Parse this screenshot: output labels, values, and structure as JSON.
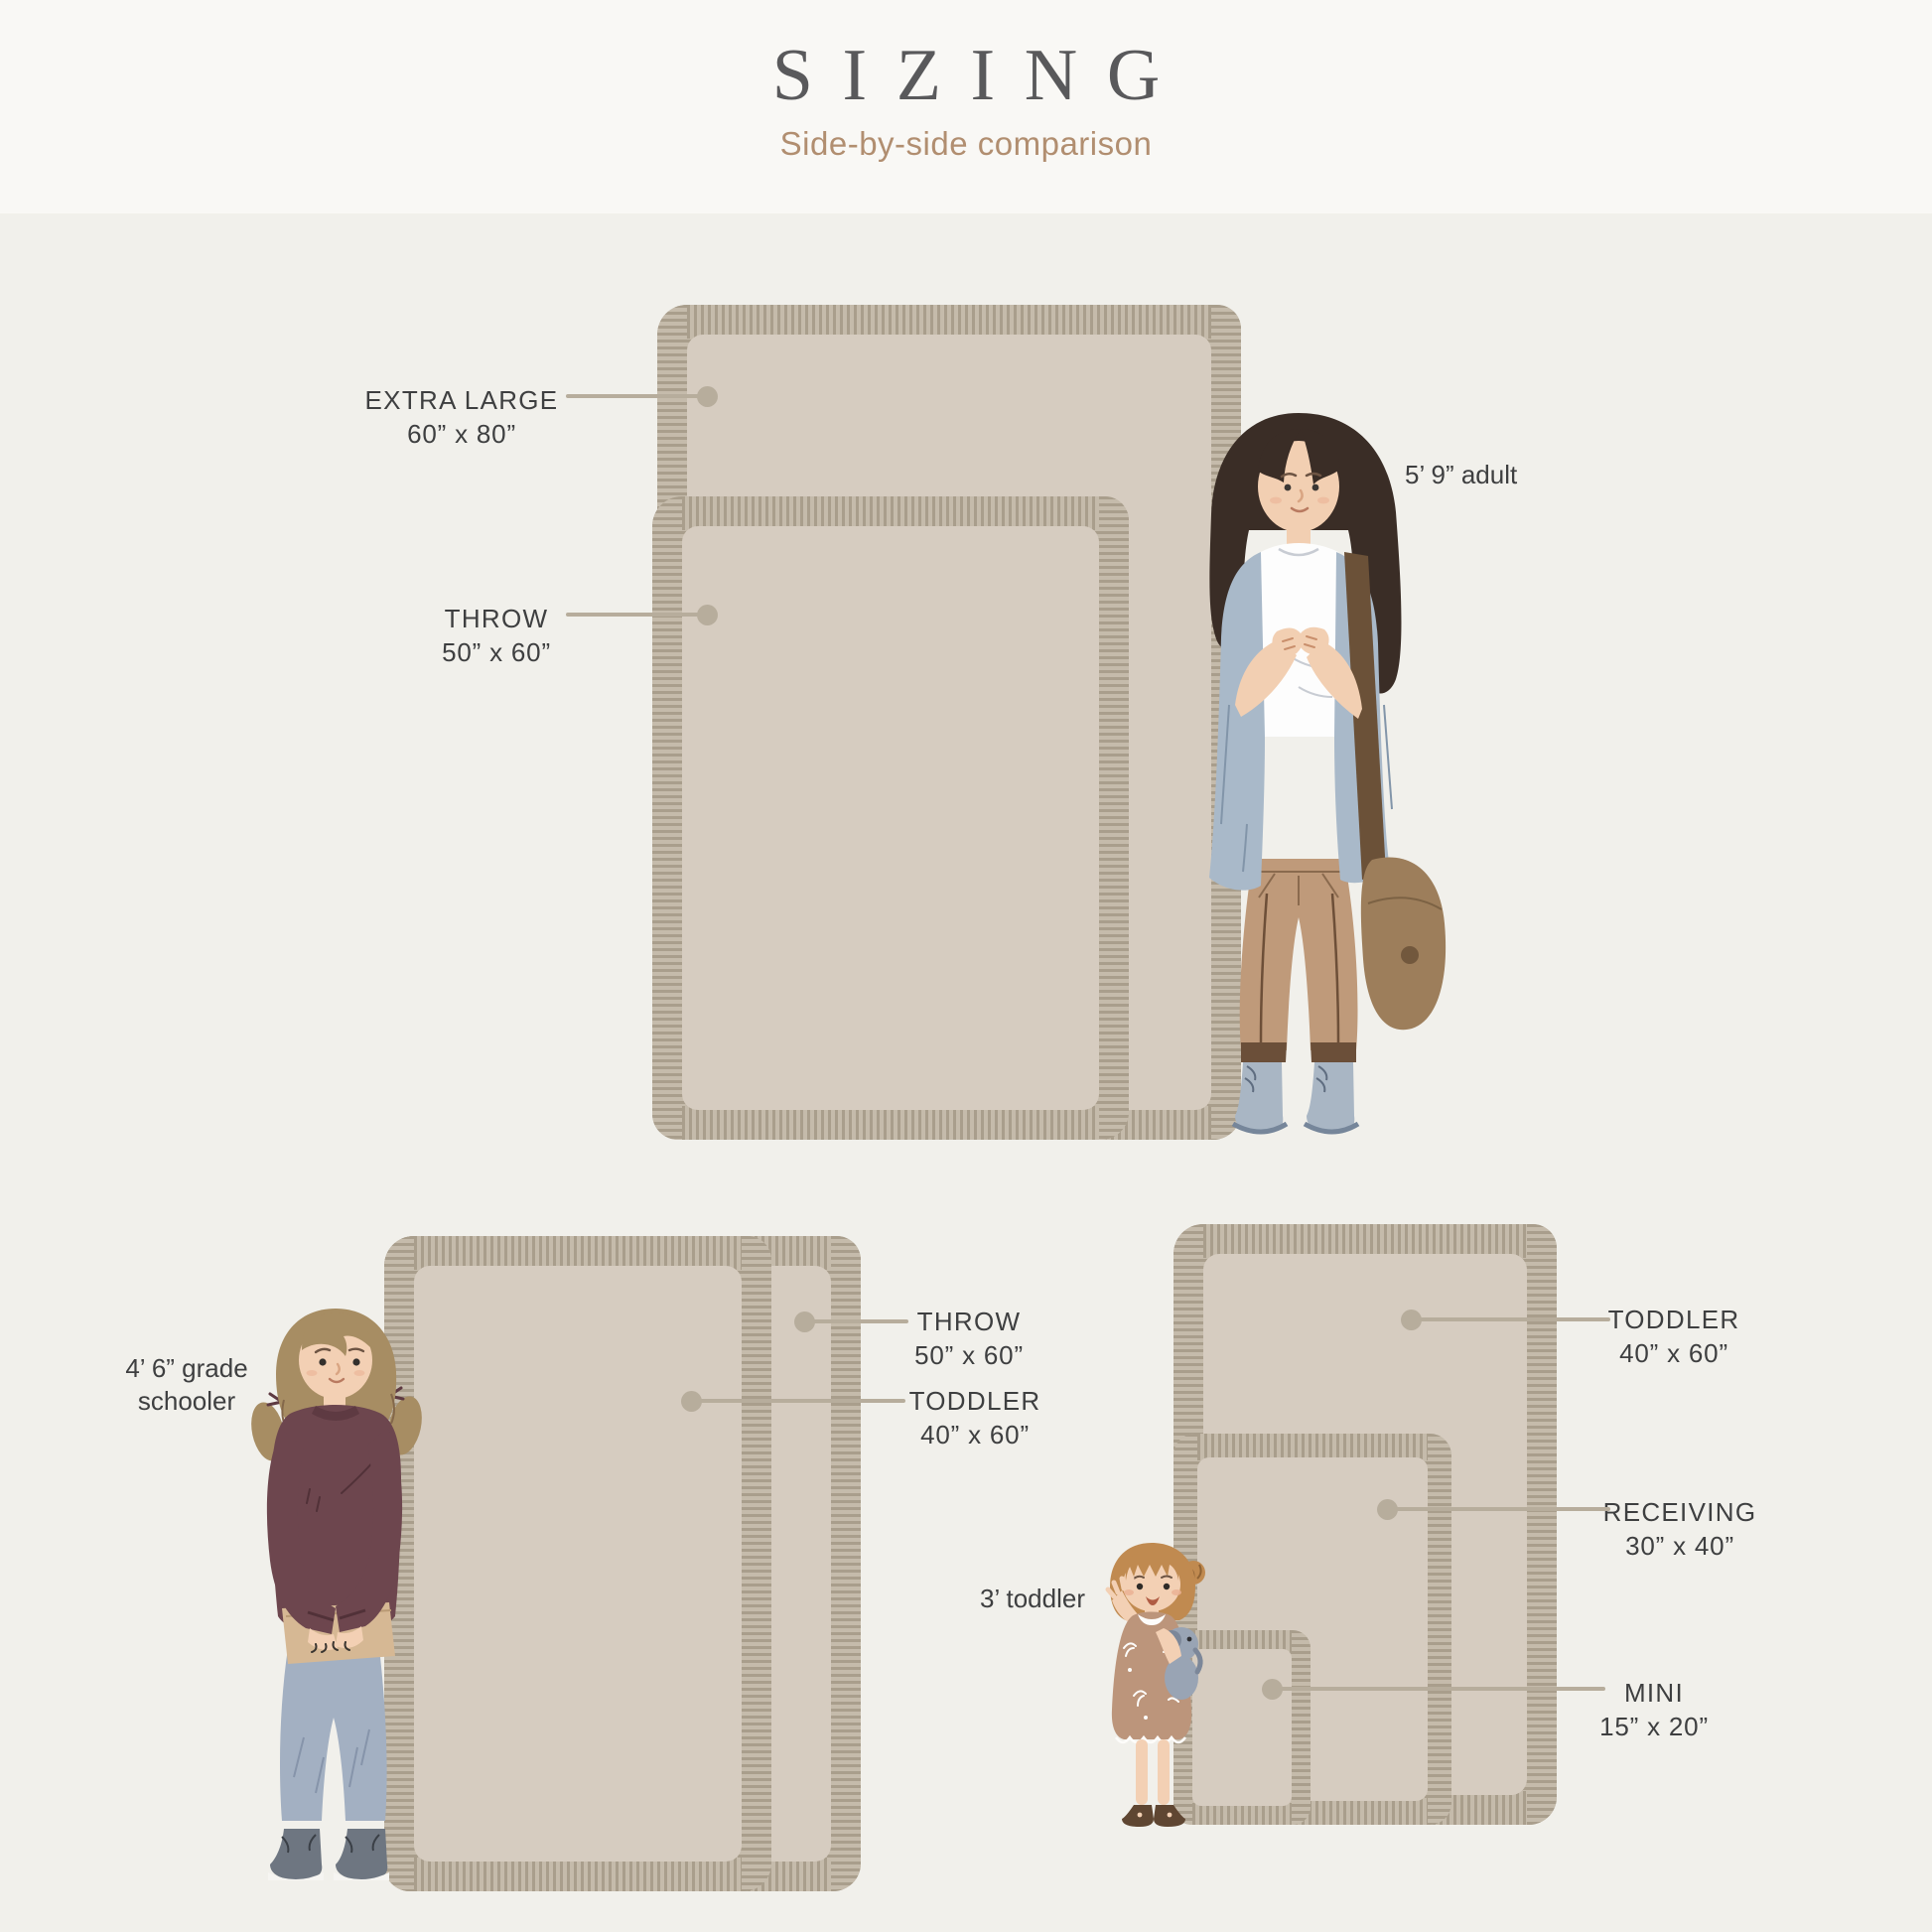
{
  "header": {
    "title": "SIZING",
    "subtitle": "Side-by-side comparison"
  },
  "colors": {
    "background": "#f1f0eb",
    "header_background": "#f9f8f5",
    "blanket_fringe": "#a99e8c",
    "blanket_fill": "#d6ccc0",
    "leader_line": "#b7ad9c",
    "label_text": "#3e3f40",
    "subtitle_text": "#b18e70",
    "title_text": "#59595b"
  },
  "sections": {
    "top": {
      "extra_large": {
        "name": "EXTRA LARGE",
        "dims": "60” x 80”"
      },
      "throw": {
        "name": "THROW",
        "dims": "50” x 60”"
      },
      "person": "5’ 9” adult"
    },
    "bottom_left": {
      "throw": {
        "name": "THROW",
        "dims": "50” x 60”"
      },
      "toddler": {
        "name": "TODDLER",
        "dims": "40” x 60”"
      },
      "person": "4’ 6” grade schooler"
    },
    "bottom_right": {
      "toddler": {
        "name": "TODDLER",
        "dims": "40” x 60”"
      },
      "receiving": {
        "name": "RECEIVING",
        "dims": "30” x 40”"
      },
      "mini": {
        "name": "MINI",
        "dims": "15” x 20”"
      },
      "person": "3’ toddler"
    }
  }
}
